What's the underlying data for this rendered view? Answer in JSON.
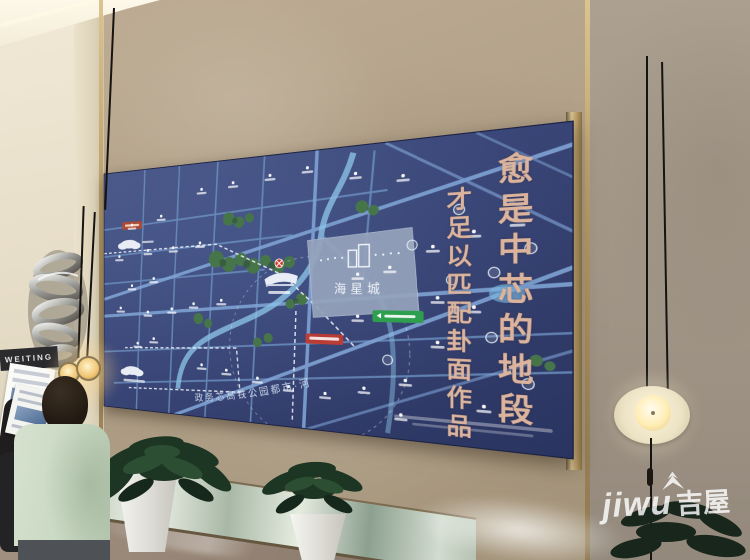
{
  "scene": {
    "description": "lobby photo with illuminated area map board",
    "wall_sign_label": "WEITING",
    "watermark": {
      "latin": "jiwu",
      "cjk": "吉屋"
    },
    "board": {
      "calligraphy_column_right": "愈是中芯的地段",
      "calligraphy_column_left": "才足以匹配卦面作品",
      "project_name": "海星城",
      "road_arc_label": "政务芯高铁公园都市·河"
    },
    "colors": {
      "map_background": "#3a4677",
      "map_road": "#7fa3d4",
      "calligraphy": "#dcb49e",
      "wall_marble": "#b3a28a",
      "accent_green": "#2e9e4f",
      "accent_red": "#bf3b30"
    }
  }
}
